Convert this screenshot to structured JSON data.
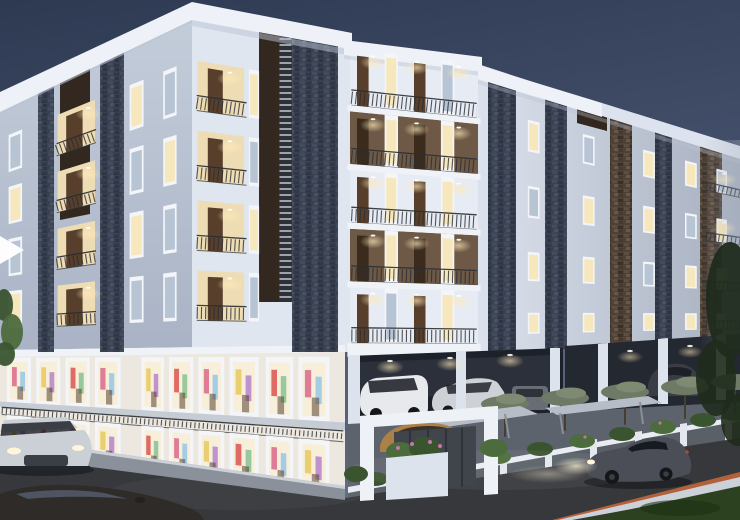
{
  "colors": {
    "sky_top": "#2e3952",
    "sky_mid": "#45516c",
    "sky_low": "#5d687f",
    "sky_glow": "#9aa1af",
    "parapet": "#eef2f8",
    "parapet2": "#dce3ee",
    "parapet_shade": "#b9c3d2",
    "wall_f1a": "#c3cdda",
    "wall_f1b": "#a9b3c5",
    "wall_f2": "#dfe6f0",
    "wall_f3": "#e7ecf4",
    "wall_f4a": "#dce2ed",
    "wall_f4b": "#a6afbf",
    "slab_white": "#eff3f8",
    "stone_base": "#394050",
    "stoneb_base": "#4e4136",
    "brown_panel": "#32281f",
    "louver": "#ccd4e0",
    "brown_wall": "#6d5946",
    "door_brown": "#573f2b",
    "door_dark": "#3a2b1d",
    "bay_warm": "#eeddb4",
    "glass_lit": "#f6e7bd",
    "glass_cool": "#b7c4d4",
    "frame_white": "#f3f5f8",
    "shop_face": "#ece7df",
    "shop_glass": "#f8efdb",
    "walk_slab": "#c6ccd4",
    "rail": "#2a2d32",
    "park_dark": "#1d2129",
    "park_dark2": "#242831",
    "park_back": "#2b303b",
    "col_white": "#dde3ec",
    "apron": "#5d636d",
    "gate_wall": "#40454c",
    "portal": "#eef1f6",
    "wall_low": "#596067",
    "wall_top": "#e9edf3",
    "pillar": "#e3e8f0",
    "shrub": "#3a5430",
    "shrub_hi": "#4d6c3d",
    "flower": "#c974ae",
    "canopy": "#6e7a65",
    "canopy_hi": "#7e8a72",
    "trunk": "#463d33",
    "tree_dark": "#1f2b1c",
    "canopy_slab": "#b7bdc6",
    "road": "#37383c",
    "sidewalk": "#8b919b",
    "curb": "#ccd1d9",
    "stripe": "#b2613a",
    "grass": "#2b411f",
    "car_dark": "#4b4e57",
    "car_bl": "#2e2b29",
    "car_silver": "#cbd0d6",
    "car_tan": "#ab8148",
    "glass_car": "#161a21",
    "headlight": "#fff5d9",
    "tail": "#b44a42",
    "suv_white": "#e7e9ec",
    "sedan_silver": "#ced2d7",
    "car_gray3": "#686c74",
    "wheel": "#141619",
    "arrow_white": "#ffffff"
  },
  "palette": [
    "#d96a8a",
    "#8ec3e6",
    "#e6c95c",
    "#b07cc9",
    "#d9534f",
    "#7fbf8e"
  ],
  "faces": {
    "F1": {
      "tl": [
        0,
        108
      ],
      "tr": [
        192,
        18
      ],
      "br": [
        192,
        352
      ],
      "bl": [
        0,
        352
      ]
    },
    "F2": {
      "tl": [
        192,
        18
      ],
      "tr": [
        350,
        48
      ],
      "br": [
        350,
        352
      ],
      "bl": [
        192,
        352
      ]
    },
    "F3": {
      "tl": [
        350,
        48
      ],
      "tr": [
        478,
        64
      ],
      "br": [
        478,
        357
      ],
      "bl": [
        350,
        357
      ]
    },
    "F4": {
      "tl": [
        478,
        70
      ],
      "tr": [
        740,
        150
      ],
      "br": [
        740,
        340
      ],
      "bl": [
        478,
        352
      ]
    },
    "S1": {
      "tl": [
        0,
        350
      ],
      "tr": [
        345,
        345
      ],
      "br": [
        345,
        500
      ],
      "bl": [
        0,
        453
      ]
    }
  },
  "rowsets": {
    "lw": [
      [
        0.125,
        0.275
      ],
      [
        0.335,
        0.485
      ],
      [
        0.545,
        0.695
      ],
      [
        0.755,
        0.905
      ]
    ],
    "rw": [
      [
        0.13,
        0.25
      ],
      [
        0.38,
        0.5
      ],
      [
        0.63,
        0.74
      ],
      [
        0.86,
        0.94
      ]
    ],
    "f3b": [
      [
        0.0,
        0.185
      ],
      [
        0.205,
        0.375
      ],
      [
        0.395,
        0.565
      ],
      [
        0.585,
        0.755
      ],
      [
        0.775,
        0.955
      ]
    ],
    "f3slab": [
      [
        0.185,
        0.205
      ],
      [
        0.375,
        0.395
      ],
      [
        0.565,
        0.585
      ],
      [
        0.755,
        0.775
      ],
      [
        0.955,
        1.0
      ]
    ]
  },
  "cells": [
    {
      "f": "F1",
      "t": "win",
      "u": [
        0.045,
        0.115
      ],
      "rows": "lw",
      "cs": [
        "glass_cool",
        "glass_lit",
        "glass_cool",
        "glass_lit"
      ]
    },
    {
      "f": "F1",
      "t": "poly",
      "u": [
        0.3,
        0.495
      ],
      "rows": "lw",
      "c": "bay_warm",
      "n": "balcony-recess"
    },
    {
      "f": "F1",
      "t": "door",
      "u": [
        0.345,
        0.43
      ],
      "rows": "lw",
      "c": "door_brown"
    },
    {
      "f": "F1",
      "t": "rail",
      "u": [
        0.295,
        0.5
      ],
      "rows": "lw",
      "rh": 0.045
    },
    {
      "f": "F1",
      "t": "spot",
      "u": 0.46,
      "rows": "lw",
      "dv": 0.02
    },
    {
      "f": "F1",
      "t": "win",
      "u": [
        0.675,
        0.748
      ],
      "rows": "lw",
      "cs": [
        "glass_lit",
        "glass_cool",
        "glass_lit",
        "glass_cool"
      ]
    },
    {
      "f": "F1",
      "t": "win",
      "u": [
        0.85,
        0.92
      ],
      "rows": "lw",
      "cs": [
        "glass_cool",
        "glass_lit",
        "glass_cool",
        "glass_cool"
      ]
    },
    {
      "f": "F2",
      "t": "poly",
      "u": [
        0.035,
        0.33
      ],
      "rows": "lw",
      "c": "bay_warm",
      "n": "balcony-recess"
    },
    {
      "f": "F2",
      "t": "door",
      "u": [
        0.1,
        0.195
      ],
      "rows": "lw",
      "c": "door_brown"
    },
    {
      "f": "F2",
      "t": "rail",
      "u": [
        0.03,
        0.345
      ],
      "rows": "lw",
      "rh": 0.045
    },
    {
      "f": "F2",
      "t": "spot",
      "u": 0.24,
      "rows": "lw",
      "dv": 0.02
    },
    {
      "f": "F2",
      "t": "win",
      "u": [
        0.36,
        0.425
      ],
      "rows": "lw",
      "cs": [
        "glass_lit",
        "glass_cool",
        "glass_lit",
        "glass_cool"
      ]
    },
    {
      "f": "F3",
      "t": "poly",
      "u": [
        0,
        1
      ],
      "rows": [
        [
          0.205,
          0.375
        ],
        [
          0.585,
          0.755
        ]
      ],
      "c": "brown_wall",
      "n": "balcony-wall"
    },
    {
      "f": "F3",
      "t": "door",
      "u": [
        0.055,
        0.145
      ],
      "rows": "f3b",
      "cs": [
        "door_brown",
        "door_dark",
        "door_brown",
        "door_dark",
        "door_brown"
      ]
    },
    {
      "f": "F3",
      "t": "win",
      "u": [
        0.27,
        0.375
      ],
      "rows": "f3b",
      "cs": [
        "glass_lit",
        "glass_lit",
        "glass_lit",
        "glass_lit",
        "glass_cool"
      ]
    },
    {
      "f": "F3",
      "t": "door",
      "u": [
        0.5,
        0.59
      ],
      "rows": "f3b",
      "cs": [
        "door_brown",
        "door_dark",
        "door_brown",
        "door_dark",
        "door_brown"
      ]
    },
    {
      "f": "F3",
      "t": "win",
      "u": [
        0.71,
        0.815
      ],
      "rows": "f3b",
      "cs": [
        "glass_cool",
        "glass_lit",
        "glass_lit",
        "glass_lit",
        "glass_lit"
      ]
    },
    {
      "f": "F3",
      "t": "rail",
      "u": [
        0.01,
        0.99
      ],
      "rows": "f3b",
      "rh": 0.05
    },
    {
      "f": "F3",
      "t": "spot",
      "u": 0.18,
      "rows": "f3b",
      "dv": 0.018
    },
    {
      "f": "F3",
      "t": "spot",
      "u": 0.52,
      "rows": "f3b",
      "dv": 0.018
    },
    {
      "f": "F3",
      "t": "spot",
      "u": 0.85,
      "rows": "f3b",
      "dv": 0.018
    },
    {
      "f": "F3",
      "t": "poly",
      "u": [
        -0.02,
        1.02
      ],
      "rows": "f3slab",
      "c": "slab_white",
      "n": "floor-slab"
    },
    {
      "f": "F4",
      "t": "win",
      "u": [
        0.19,
        0.235
      ],
      "rows": "rw",
      "cs": [
        "glass_lit",
        "glass_cool",
        "glass_lit",
        "glass_lit"
      ]
    },
    {
      "f": "F4",
      "t": "win",
      "u": [
        0.4,
        0.445
      ],
      "rows": "rw",
      "cs": [
        "glass_cool",
        "glass_lit",
        "glass_lit",
        "glass_lit"
      ]
    },
    {
      "f": "F4",
      "t": "win",
      "u": [
        0.63,
        0.675
      ],
      "rows": "rw",
      "cs": [
        "glass_lit",
        "glass_lit",
        "glass_cool",
        "glass_lit"
      ]
    },
    {
      "f": "F4",
      "t": "win",
      "u": [
        0.79,
        0.835
      ],
      "rows": "rw",
      "cs": [
        "glass_lit",
        "glass_cool",
        "glass_lit",
        "glass_lit"
      ]
    },
    {
      "f": "F4",
      "t": "win",
      "u": [
        0.91,
        0.95
      ],
      "rows": "rw",
      "cs": [
        "glass_cool",
        "glass_lit",
        "glass_lit",
        "glass_lit"
      ]
    },
    {
      "f": "F4",
      "t": "rail",
      "u": [
        0.87,
        1.0
      ],
      "rows": "rw",
      "rh": 0.04
    },
    {
      "f": "F4",
      "t": "spot",
      "u": 0.94,
      "rows": [
        [
          0.13,
          0.25
        ],
        [
          0.38,
          0.5
        ]
      ],
      "dv": 0.016
    },
    {
      "f": "S1",
      "t": "win",
      "u": [
        0.02,
        0.09
      ],
      "v": [
        0.075,
        0.5
      ],
      "c": "shop_glass",
      "d": 1
    },
    {
      "f": "S1",
      "t": "win",
      "u": [
        0.105,
        0.175
      ],
      "v": [
        0.075,
        0.5
      ],
      "c": "shop_glass",
      "d": 1
    },
    {
      "f": "S1",
      "t": "win",
      "u": [
        0.19,
        0.26
      ],
      "v": [
        0.075,
        0.5
      ],
      "c": "shop_glass",
      "d": 1
    },
    {
      "f": "S1",
      "t": "win",
      "u": [
        0.275,
        0.35
      ],
      "v": [
        0.075,
        0.5
      ],
      "c": "shop_glass",
      "d": 1
    },
    {
      "f": "S1",
      "t": "win",
      "u": [
        0.41,
        0.475
      ],
      "v": [
        0.075,
        0.5
      ],
      "c": "shop_glass",
      "d": 1
    },
    {
      "f": "S1",
      "t": "win",
      "u": [
        0.49,
        0.56
      ],
      "v": [
        0.075,
        0.5
      ],
      "c": "shop_glass",
      "d": 1
    },
    {
      "f": "S1",
      "t": "win",
      "u": [
        0.575,
        0.65
      ],
      "v": [
        0.075,
        0.5
      ],
      "c": "shop_glass",
      "d": 1
    },
    {
      "f": "S1",
      "t": "win",
      "u": [
        0.665,
        0.75
      ],
      "v": [
        0.075,
        0.5
      ],
      "c": "shop_glass",
      "d": 1
    },
    {
      "f": "S1",
      "t": "win",
      "u": [
        0.77,
        0.85
      ],
      "v": [
        0.075,
        0.5
      ],
      "c": "shop_glass",
      "d": 1
    },
    {
      "f": "S1",
      "t": "win",
      "u": [
        0.865,
        0.955
      ],
      "v": [
        0.075,
        0.5
      ],
      "c": "shop_glass",
      "d": 1
    },
    {
      "f": "S1",
      "t": "poly",
      "u": [
        0,
        1
      ],
      "v": [
        0.5,
        0.55
      ],
      "c": "walk_slab",
      "n": "walkway-slab"
    },
    {
      "f": "S1",
      "t": "rail",
      "u": [
        0.005,
        0.995
      ],
      "v": [
        0.55,
        0.625
      ],
      "rh": 0.07
    },
    {
      "f": "S1",
      "t": "win",
      "u": [
        0.02,
        0.09
      ],
      "v": [
        0.625,
        0.985
      ],
      "c": "shop_glass",
      "d": 1
    },
    {
      "f": "S1",
      "t": "win",
      "u": [
        0.105,
        0.175
      ],
      "v": [
        0.625,
        0.985
      ],
      "c": "shop_glass",
      "d": 1
    },
    {
      "f": "S1",
      "t": "win",
      "u": [
        0.19,
        0.26
      ],
      "v": [
        0.625,
        0.985
      ],
      "c": "shop_glass",
      "d": 1
    },
    {
      "f": "S1",
      "t": "win",
      "u": [
        0.275,
        0.35
      ],
      "v": [
        0.625,
        0.985
      ],
      "c": "shop_glass",
      "d": 1
    },
    {
      "f": "S1",
      "t": "win",
      "u": [
        0.41,
        0.475
      ],
      "v": [
        0.625,
        0.985
      ],
      "c": "shop_glass",
      "d": 1
    },
    {
      "f": "S1",
      "t": "win",
      "u": [
        0.49,
        0.56
      ],
      "v": [
        0.625,
        0.985
      ],
      "c": "shop_glass",
      "d": 1
    },
    {
      "f": "S1",
      "t": "win",
      "u": [
        0.575,
        0.65
      ],
      "v": [
        0.625,
        0.985
      ],
      "c": "shop_glass",
      "d": 1
    },
    {
      "f": "S1",
      "t": "win",
      "u": [
        0.665,
        0.75
      ],
      "v": [
        0.625,
        0.985
      ],
      "c": "shop_glass",
      "d": 1
    },
    {
      "f": "S1",
      "t": "win",
      "u": [
        0.77,
        0.85
      ],
      "v": [
        0.625,
        0.985
      ],
      "c": "shop_glass",
      "d": 1
    },
    {
      "f": "S1",
      "t": "win",
      "u": [
        0.865,
        0.955
      ],
      "v": [
        0.625,
        0.985
      ],
      "c": "shop_glass",
      "d": 1
    }
  ]
}
